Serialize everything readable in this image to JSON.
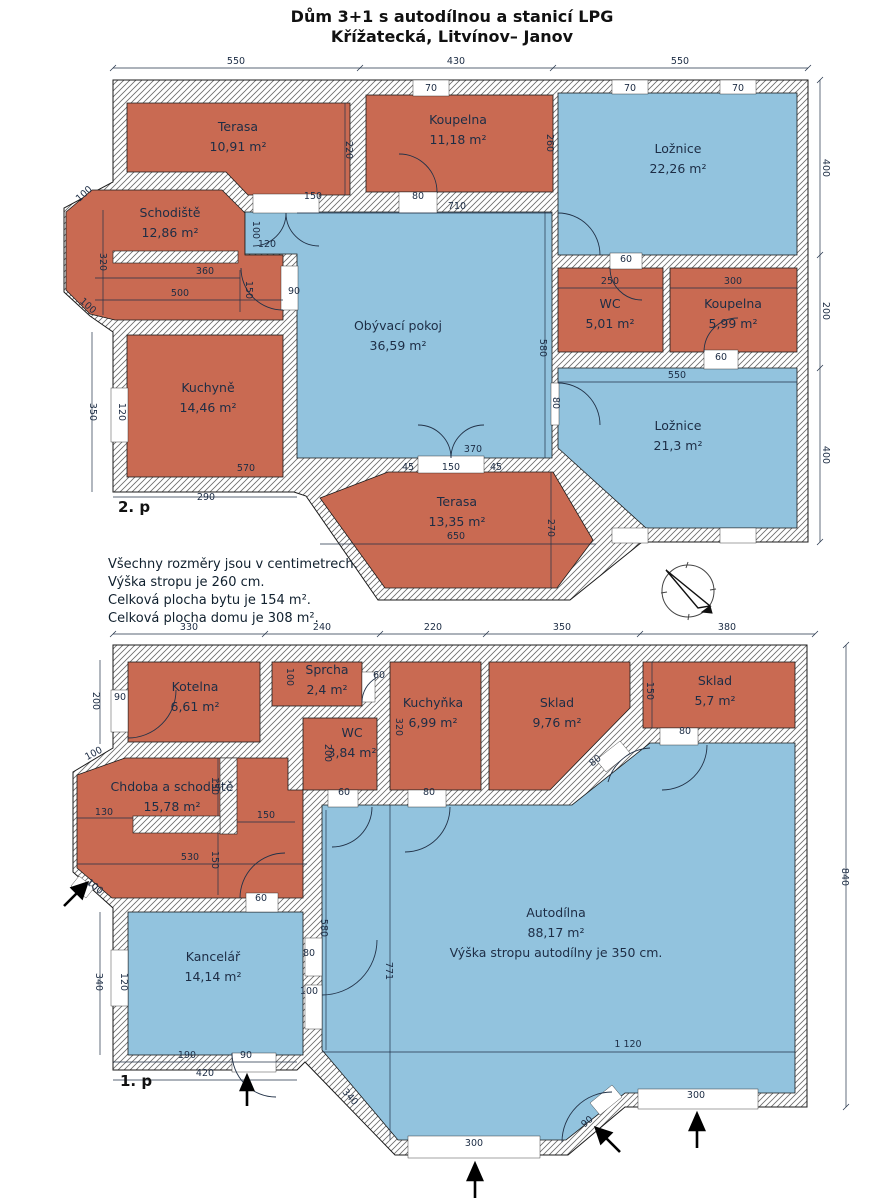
{
  "title": {
    "line1": "Dům 3+1 s autodílnou a stanicí LPG",
    "line2": "Křížatecká, Litvínov– Janov"
  },
  "floors": {
    "upper_label": "2. p",
    "lower_label": "1. p"
  },
  "notes": [
    "Všechny rozměry jsou v centimetrech.",
    "Výška stropu je 260 cm.",
    "Celková plocha bytu je 154 m².",
    "Celková plocha domu je 308 m²."
  ],
  "colors": {
    "room_red": "#c96a52",
    "room_blue": "#92c3de",
    "wall_hatch_line": "#6b6b6b",
    "outline": "#1b1b1b",
    "dim_text": "#1c2c44"
  },
  "icons": {
    "compass": "north-compass-icon",
    "entrance": "entrance-arrow"
  },
  "rooms": [
    {
      "name": "Terasa",
      "area": "10,91 m²",
      "color": "red",
      "x": 238,
      "y": 131,
      "floor": "2.p"
    },
    {
      "name": "Koupelna",
      "area": "11,18 m²",
      "color": "red",
      "x": 458,
      "y": 124,
      "floor": "2.p"
    },
    {
      "name": "Ložnice",
      "area": "22,26 m²",
      "color": "blue",
      "x": 678,
      "y": 153,
      "floor": "2.p"
    },
    {
      "name": "Schodiště",
      "area": "12,86 m²",
      "color": "red",
      "x": 170,
      "y": 217,
      "floor": "2.p"
    },
    {
      "name": "Obývací pokoj",
      "area": "36,59 m²",
      "color": "blue",
      "x": 398,
      "y": 330,
      "floor": "2.p"
    },
    {
      "name": "WC",
      "area": "5,01 m²",
      "color": "red",
      "x": 610,
      "y": 308,
      "floor": "2.p"
    },
    {
      "name": "Koupelna",
      "area": "5,99 m²",
      "color": "red",
      "x": 733,
      "y": 308,
      "floor": "2.p"
    },
    {
      "name": "Kuchyně",
      "area": "14,46 m²",
      "color": "red",
      "x": 208,
      "y": 392,
      "floor": "2.p"
    },
    {
      "name": "Ložnice",
      "area": "21,3 m²",
      "color": "blue",
      "x": 678,
      "y": 430,
      "floor": "2.p"
    },
    {
      "name": "Terasa",
      "area": "13,35 m²",
      "color": "red",
      "x": 457,
      "y": 506,
      "floor": "2.p"
    },
    {
      "name": "Kotelna",
      "area": "6,61 m²",
      "color": "red",
      "x": 195,
      "y": 691,
      "floor": "1.p"
    },
    {
      "name": "Sprcha",
      "area": "2,4 m²",
      "color": "red",
      "x": 327,
      "y": 674,
      "floor": "1.p"
    },
    {
      "name": "WC",
      "area": "3,84 m²",
      "color": "red",
      "x": 352,
      "y": 737,
      "floor": "1.p"
    },
    {
      "name": "Kuchyňka",
      "area": "6,99 m²",
      "color": "red",
      "x": 433,
      "y": 707,
      "floor": "1.p"
    },
    {
      "name": "Sklad",
      "area": "9,76 m²",
      "color": "red",
      "x": 557,
      "y": 707,
      "floor": "1.p"
    },
    {
      "name": "Sklad",
      "area": "5,7 m²",
      "color": "red",
      "x": 715,
      "y": 685,
      "floor": "1.p"
    },
    {
      "name": "Chdoba a schodiště",
      "area": "15,78 m²",
      "color": "red",
      "x": 172,
      "y": 791,
      "floor": "1.p"
    },
    {
      "name": "Kancelář",
      "area": "14,14 m²",
      "color": "blue",
      "x": 213,
      "y": 961,
      "floor": "1.p"
    },
    {
      "name": "Autodílna",
      "area": "88,17 m²",
      "color": "blue",
      "x": 556,
      "y": 917,
      "floor": "1.p",
      "note": "Výška stropu autodílny je 350 cm."
    }
  ],
  "dims": [
    {
      "t": "550",
      "x": 236,
      "y": 64
    },
    {
      "t": "430",
      "x": 456,
      "y": 64
    },
    {
      "t": "550",
      "x": 680,
      "y": 64
    },
    {
      "t": "70",
      "x": 431,
      "y": 91
    },
    {
      "t": "70",
      "x": 630,
      "y": 91
    },
    {
      "t": "70",
      "x": 738,
      "y": 91
    },
    {
      "t": "400",
      "x": 823,
      "y": 168,
      "r": 90
    },
    {
      "t": "200",
      "x": 823,
      "y": 311,
      "r": 90
    },
    {
      "t": "400",
      "x": 823,
      "y": 455,
      "r": 90
    },
    {
      "t": "220",
      "x": 346,
      "y": 150,
      "r": 90
    },
    {
      "t": "150",
      "x": 313,
      "y": 199
    },
    {
      "t": "710",
      "x": 457,
      "y": 209
    },
    {
      "t": "80",
      "x": 418,
      "y": 199
    },
    {
      "t": "260",
      "x": 547,
      "y": 143,
      "r": 90
    },
    {
      "t": "100",
      "x": 253,
      "y": 230,
      "r": 90
    },
    {
      "t": "120",
      "x": 267,
      "y": 247
    },
    {
      "t": "580",
      "x": 540,
      "y": 348,
      "r": 90
    },
    {
      "t": "100",
      "x": 86,
      "y": 196,
      "r": -42
    },
    {
      "t": "320",
      "x": 100,
      "y": 262,
      "r": 90
    },
    {
      "t": "360",
      "x": 205,
      "y": 274
    },
    {
      "t": "500",
      "x": 180,
      "y": 296
    },
    {
      "t": "150",
      "x": 246,
      "y": 290,
      "r": 90
    },
    {
      "t": "90",
      "x": 294,
      "y": 294
    },
    {
      "t": "100",
      "x": 86,
      "y": 308,
      "r": 42
    },
    {
      "t": "350",
      "x": 90,
      "y": 412,
      "r": 90
    },
    {
      "t": "120",
      "x": 119,
      "y": 412,
      "r": 90
    },
    {
      "t": "570",
      "x": 246,
      "y": 471
    },
    {
      "t": "290",
      "x": 206,
      "y": 500
    },
    {
      "t": "60",
      "x": 626,
      "y": 262
    },
    {
      "t": "250",
      "x": 610,
      "y": 284
    },
    {
      "t": "300",
      "x": 733,
      "y": 284
    },
    {
      "t": "60",
      "x": 721,
      "y": 360
    },
    {
      "t": "550",
      "x": 677,
      "y": 378
    },
    {
      "t": "80",
      "x": 553,
      "y": 403,
      "r": 90
    },
    {
      "t": "370",
      "x": 473,
      "y": 452
    },
    {
      "t": "45",
      "x": 408,
      "y": 470
    },
    {
      "t": "150",
      "x": 451,
      "y": 470
    },
    {
      "t": "45",
      "x": 496,
      "y": 470
    },
    {
      "t": "650",
      "x": 456,
      "y": 539
    },
    {
      "t": "270",
      "x": 548,
      "y": 528,
      "r": 90
    },
    {
      "t": "330",
      "x": 189,
      "y": 630
    },
    {
      "t": "240",
      "x": 322,
      "y": 630
    },
    {
      "t": "220",
      "x": 433,
      "y": 630
    },
    {
      "t": "350",
      "x": 562,
      "y": 630
    },
    {
      "t": "380",
      "x": 727,
      "y": 630
    },
    {
      "t": "200",
      "x": 93,
      "y": 701,
      "r": 90
    },
    {
      "t": "90",
      "x": 120,
      "y": 700
    },
    {
      "t": "100",
      "x": 287,
      "y": 677,
      "r": 90
    },
    {
      "t": "60",
      "x": 379,
      "y": 678
    },
    {
      "t": "200",
      "x": 325,
      "y": 753,
      "r": 90
    },
    {
      "t": "320",
      "x": 396,
      "y": 727,
      "r": 90
    },
    {
      "t": "60",
      "x": 344,
      "y": 795
    },
    {
      "t": "80",
      "x": 429,
      "y": 795
    },
    {
      "t": "150",
      "x": 647,
      "y": 691,
      "r": 90
    },
    {
      "t": "80",
      "x": 685,
      "y": 734
    },
    {
      "t": "80",
      "x": 597,
      "y": 763,
      "r": -38
    },
    {
      "t": "100",
      "x": 95,
      "y": 756,
      "r": -28
    },
    {
      "t": "150",
      "x": 212,
      "y": 786,
      "r": 90
    },
    {
      "t": "130",
      "x": 104,
      "y": 815
    },
    {
      "t": "150",
      "x": 266,
      "y": 818
    },
    {
      "t": "530",
      "x": 190,
      "y": 860
    },
    {
      "t": "150",
      "x": 212,
      "y": 860,
      "r": 90
    },
    {
      "t": "100",
      "x": 93,
      "y": 889,
      "r": 38
    },
    {
      "t": "60",
      "x": 261,
      "y": 901
    },
    {
      "t": "340",
      "x": 96,
      "y": 982,
      "r": 90
    },
    {
      "t": "120",
      "x": 121,
      "y": 982,
      "r": 90
    },
    {
      "t": "580",
      "x": 321,
      "y": 928,
      "r": 90
    },
    {
      "t": "80",
      "x": 309,
      "y": 956
    },
    {
      "t": "100",
      "x": 309,
      "y": 994
    },
    {
      "t": "190",
      "x": 187,
      "y": 1058
    },
    {
      "t": "90",
      "x": 246,
      "y": 1058
    },
    {
      "t": "420",
      "x": 205,
      "y": 1076
    },
    {
      "t": "771",
      "x": 386,
      "y": 971,
      "r": 90
    },
    {
      "t": "1 120",
      "x": 628,
      "y": 1047
    },
    {
      "t": "840",
      "x": 842,
      "y": 877,
      "r": 90
    },
    {
      "t": "340",
      "x": 348,
      "y": 1099,
      "r": 48
    },
    {
      "t": "300",
      "x": 474,
      "y": 1146
    },
    {
      "t": "90",
      "x": 589,
      "y": 1124,
      "r": -40
    },
    {
      "t": "300",
      "x": 696,
      "y": 1098
    }
  ]
}
